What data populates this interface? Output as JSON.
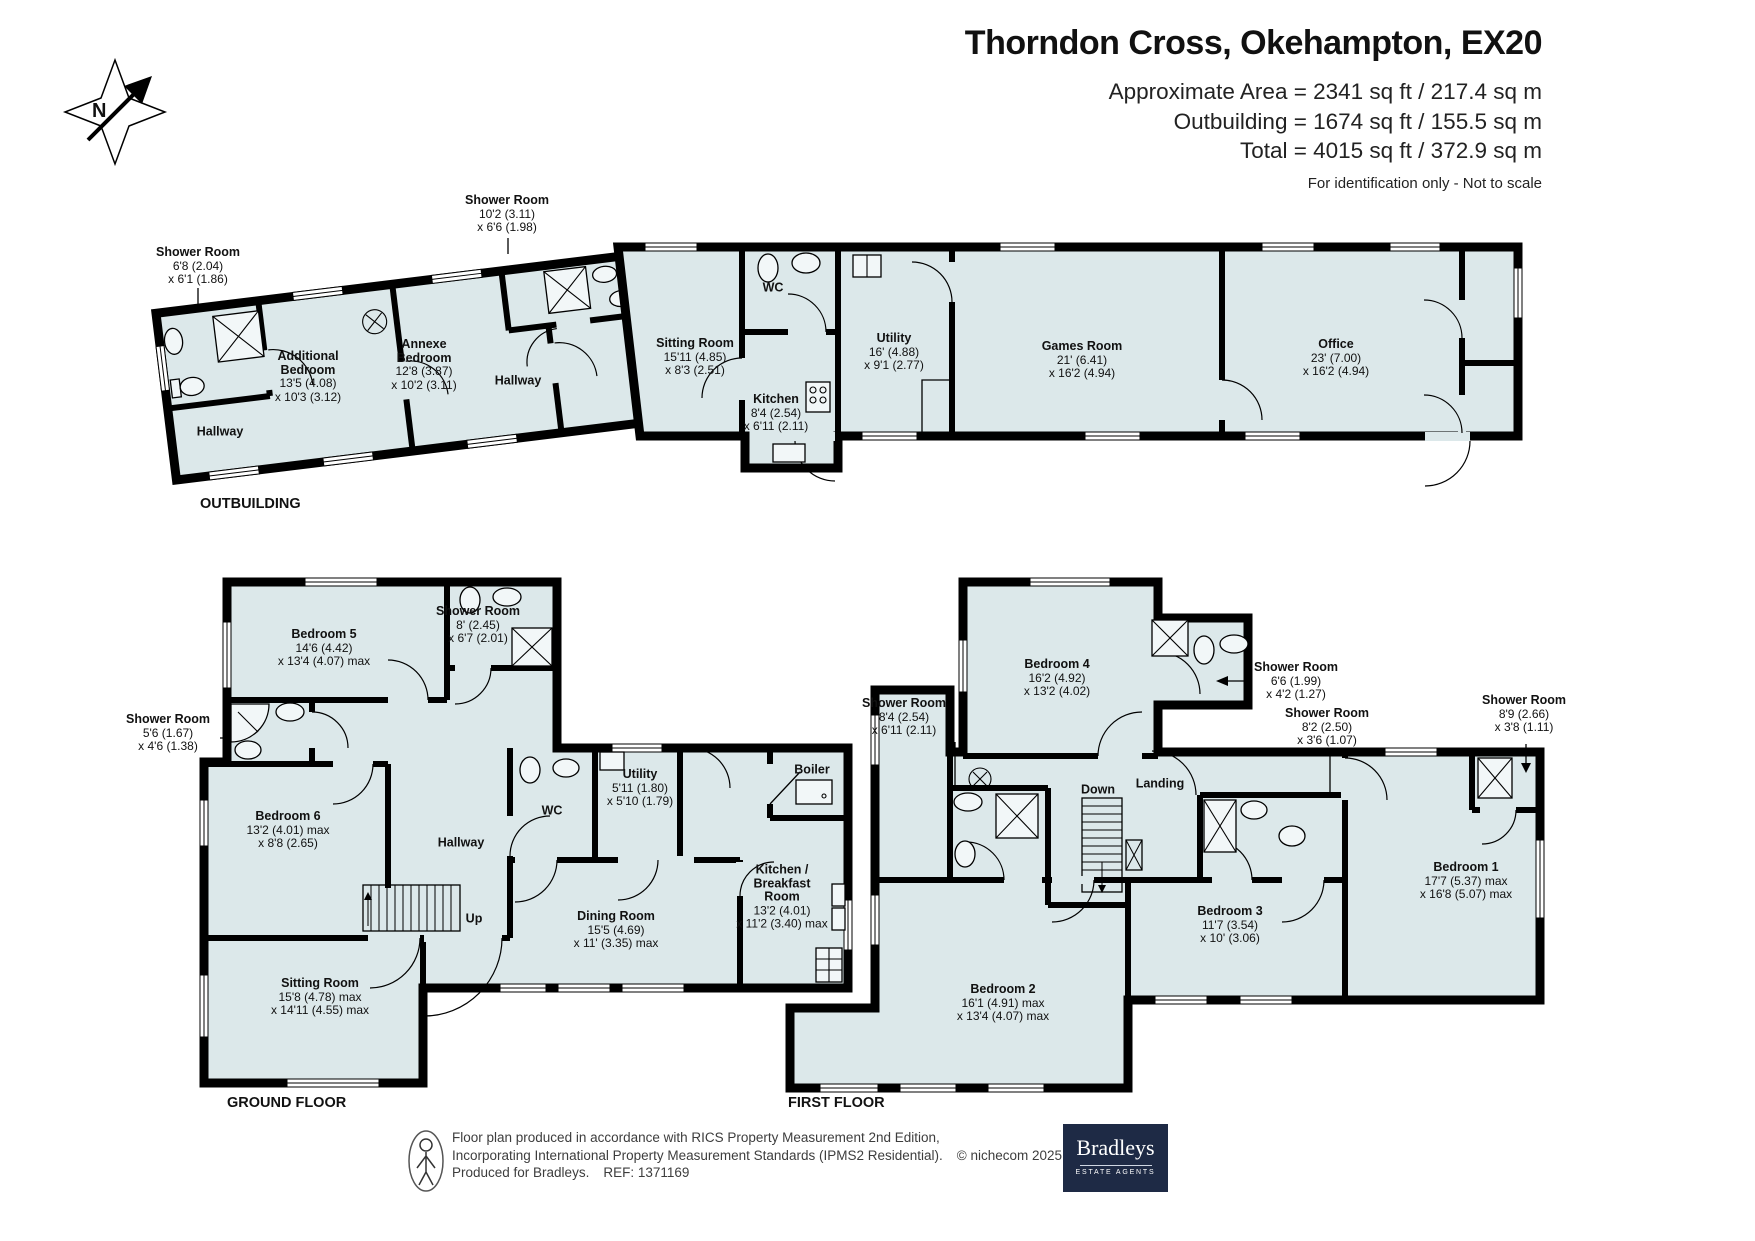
{
  "header": {
    "title": "Thorndon Cross, Okehampton, EX20",
    "area_line1": "Approximate Area = 2341 sq ft / 217.4 sq m",
    "area_line2": "Outbuilding = 1674 sq ft / 155.5 sq m",
    "area_line3": "Total = 4015 sq ft / 372.9 sq m",
    "disclaimer": "For identification only - Not to scale"
  },
  "compass": {
    "n": "N"
  },
  "plans": {
    "ob": {
      "caption": "OUTBUILDING",
      "rooms": {
        "sh_l": {
          "n": "Shower Room",
          "d1": "6'8 (2.04)",
          "d2": "x 6'1 (1.86)"
        },
        "sh_t": {
          "n": "Shower Room",
          "d1": "10'2 (3.11)",
          "d2": "x 6'6 (1.98)"
        },
        "hall_l": {
          "n": "Hallway"
        },
        "add_bed": {
          "n1": "Additional",
          "n2": "Bedroom",
          "d1": "13'5 (4.08)",
          "d2": "x 10'3 (3.12)"
        },
        "annexe": {
          "n1": "Annexe",
          "n2": "Bedroom",
          "d1": "12'8 (3.87)",
          "d2": "x 10'2 (3.11)"
        },
        "hall_m": {
          "n": "Hallway"
        },
        "sitting": {
          "n": "Sitting Room",
          "d1": "15'11 (4.85)",
          "d2": "x 8'3 (2.51)"
        },
        "wc": {
          "n": "WC"
        },
        "kitchen": {
          "n": "Kitchen",
          "d1": "8'4 (2.54)",
          "d2": "x 6'11 (2.11)"
        },
        "utility": {
          "n": "Utility",
          "d1": "16' (4.88)",
          "d2": "x 9'1 (2.77)"
        },
        "games": {
          "n": "Games Room",
          "d1": "21' (6.41)",
          "d2": "x 16'2 (4.94)"
        },
        "office": {
          "n": "Office",
          "d1": "23' (7.00)",
          "d2": "x 16'2 (4.94)"
        }
      }
    },
    "gf": {
      "caption": "GROUND FLOOR",
      "rooms": {
        "bed5": {
          "n": "Bedroom 5",
          "d1": "14'6 (4.42)",
          "d2": "x 13'4 (4.07) max"
        },
        "sh8": {
          "n": "Shower Room",
          "d1": "8' (2.45)",
          "d2": "x 6'7 (2.01)"
        },
        "sh56": {
          "n": "Shower Room",
          "d1": "5'6 (1.67)",
          "d2": "x 4'6 (1.38)"
        },
        "bed6": {
          "n": "Bedroom 6",
          "d1": "13'2 (4.01) max",
          "d2": "x 8'8 (2.65)"
        },
        "hall": {
          "n": "Hallway"
        },
        "wc": {
          "n": "WC"
        },
        "utility": {
          "n": "Utility",
          "d1": "5'11 (1.80)",
          "d2": "x 5'10 (1.79)"
        },
        "boiler": {
          "n": "Boiler"
        },
        "kitchen": {
          "n1": "Kitchen /",
          "n2": "Breakfast",
          "n3": "Room",
          "d1": "13'2 (4.01)",
          "d2": "x 11'2 (3.40) max"
        },
        "dining": {
          "n": "Dining Room",
          "d1": "15'5 (4.69)",
          "d2": "x 11' (3.35) max"
        },
        "sitting": {
          "n": "Sitting Room",
          "d1": "15'8 (4.78) max",
          "d2": "x 14'11 (4.55) max"
        },
        "up": {
          "n": "Up"
        }
      }
    },
    "ff": {
      "caption": "FIRST FLOOR",
      "rooms": {
        "bed4": {
          "n": "Bedroom 4",
          "d1": "16'2 (4.92)",
          "d2": "x 13'2 (4.02)"
        },
        "sh84": {
          "n": "Shower Room",
          "d1": "8'4 (2.54)",
          "d2": "x 6'11 (2.11)"
        },
        "sh66": {
          "n": "Shower Room",
          "d1": "6'6 (1.99)",
          "d2": "x 4'2 (1.27)"
        },
        "sh82": {
          "n": "Shower Room",
          "d1": "8'2 (2.50)",
          "d2": "x 3'6 (1.07)"
        },
        "sh89": {
          "n": "Shower Room",
          "d1": "8'9 (2.66)",
          "d2": "x 3'8 (1.11)"
        },
        "landing": {
          "n": "Landing"
        },
        "down": {
          "n": "Down"
        },
        "bed3": {
          "n": "Bedroom 3",
          "d1": "11'7 (3.54)",
          "d2": "x 10' (3.06)"
        },
        "bed2": {
          "n": "Bedroom 2",
          "d1": "16'1 (4.91) max",
          "d2": "x 13'4 (4.07) max"
        },
        "bed1": {
          "n": "Bedroom 1",
          "d1": "17'7 (5.37) max",
          "d2": "x 16'8 (5.07) max"
        }
      }
    }
  },
  "footer": {
    "line1": "Floor plan produced in accordance with RICS Property Measurement 2nd Edition,",
    "line2": "Incorporating International Property Measurement Standards (IPMS2 Residential).",
    "copyright": "© nichecom 2025.",
    "produced": "Produced for Bradleys.",
    "ref": "REF: 1371169",
    "brand": {
      "name": "Bradleys",
      "tagline": "ESTATE AGENTS"
    }
  },
  "icons": {
    "compass": "compass-rose",
    "person": "person-scale-icon",
    "fixtures": [
      "toilet-icon",
      "sink-icon",
      "shower-tray-icon",
      "stove-icon",
      "boiler-icon",
      "ceiling-light-icon",
      "stairs-icon"
    ]
  },
  "colors": {
    "room_fill": "#dce8ea",
    "wall": "#000000",
    "brand_navy": "#1e2a45"
  }
}
